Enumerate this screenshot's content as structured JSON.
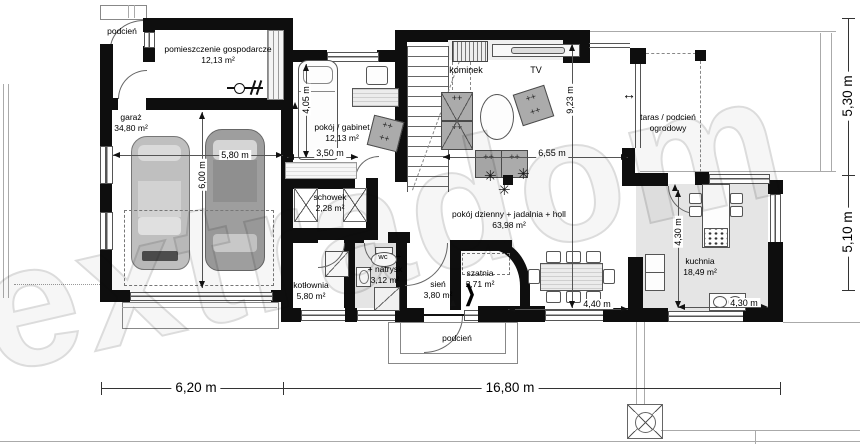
{
  "watermark": "extradom",
  "rooms": {
    "podcien_top": {
      "name": "podcień"
    },
    "pom_gosp": {
      "name": "pomieszczenie gospodarcze",
      "area": "12,13 m²"
    },
    "garaz": {
      "name": "garaż",
      "area": "34,80 m²"
    },
    "gabinet": {
      "name": "pokój / gabinet",
      "area": "12,13 m²"
    },
    "schowek": {
      "name": "schowek",
      "area": "2,28 m²"
    },
    "living": {
      "name": "pokój dzienny + jadalnia + holl",
      "area": "63,98 m²"
    },
    "taras": {
      "line1": "taras / podcień",
      "line2": "ogrodowy"
    },
    "kuchnia": {
      "name": "kuchnia",
      "area": "18,49 m²"
    },
    "kotlownia": {
      "name": "kotłownia",
      "area": "5,80 m²"
    },
    "wc": {
      "name": "wc",
      "plus": "+",
      "name2": "+ natrysk",
      "area": "3,12 m²"
    },
    "sien": {
      "name": "sień",
      "area": "3,80 m²"
    },
    "szatnia": {
      "name": "szatnia",
      "area": "2,71 m²"
    },
    "podcien_bottom": {
      "name": "podcień"
    }
  },
  "features": {
    "kominek": "kominek",
    "tv": "TV"
  },
  "dims": {
    "bed": "4,05 m",
    "gabinet_w": "3,50 m",
    "living_w": "6,55 m",
    "living_h": "9,23 m",
    "garage_w": "5,80 m",
    "garage_h": "6,00 m",
    "kitchen_h": "4,30 m",
    "kitchen_w": "4,30 m",
    "dining_w": "4,40 m",
    "total_left": "6,20 m",
    "total_right": "16,80 m",
    "side_top": "5,30 m",
    "side_bottom": "5,10 m"
  },
  "icons": {
    "plus": "+",
    "plant": "✳",
    "spread_arrow": "↔",
    "zigzag": "❯"
  }
}
